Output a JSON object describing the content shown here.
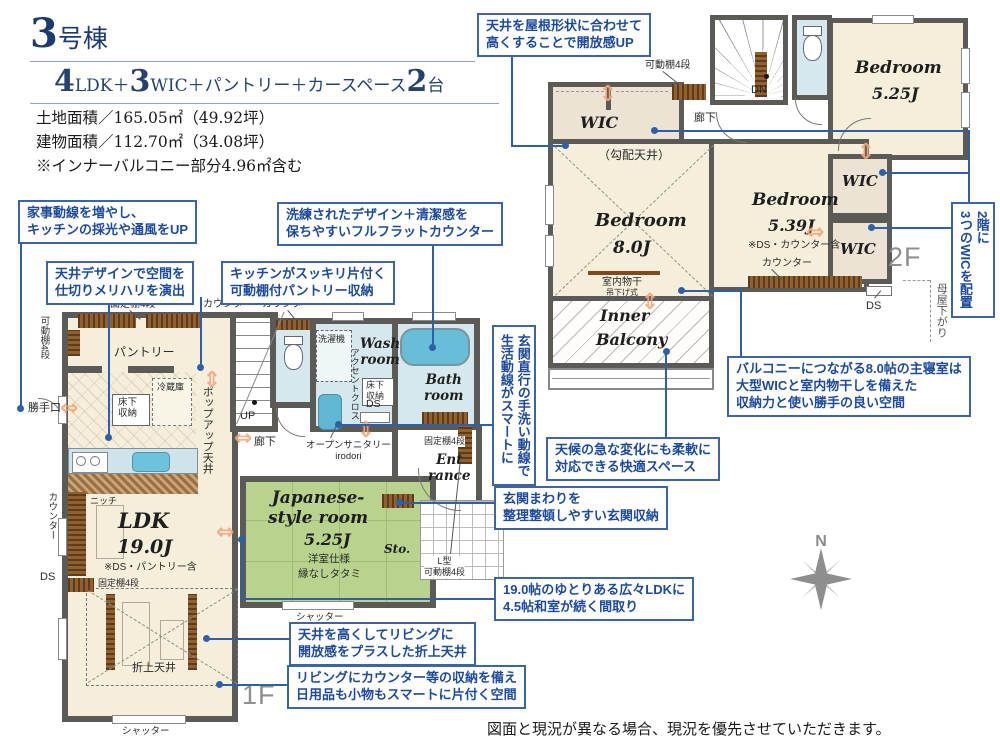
{
  "header": {
    "building_digit": "3",
    "building_suffix": "号棟",
    "layout_parts": [
      "4",
      "LDK＋",
      "3",
      "WIC＋パントリー＋カースペース",
      "2",
      "台"
    ],
    "land_area": "土地面積／165.05㎡（49.92坪）",
    "building_area": "建物面積／112.70㎡（34.08坪）",
    "note": "※インナーバルコニー部分4.96㎡含む"
  },
  "callouts": {
    "roof": "天井を屋根形状に合わせて\n高くすることで開放感UP",
    "kaji": "家事動線を増やし、\nキッチンの採光や通風をUP",
    "flat": "洗練されたデザイン＋清潔感を\n保ちやすいフルフラットカウンター",
    "ceiling": "天井デザインで空間を\n仕切りメリハリを演出",
    "pantry": "キッチンがスッキリ片付く\n可動棚付パントリー収納",
    "washline": "玄関直行の手洗い動線で\n生活動線がスマートに",
    "wic": "2階に\n3つのWICを配置",
    "master": "バルコニーにつながる8.0帖の主寝室は\n大型WICと室内物干しを備えた\n収納力と使い勝手の良い空間",
    "weather": "天候の急な変化にも柔軟に\n対応できる快適スペース",
    "genkan": "玄関まわりを\n整理整頓しやすい玄関収納",
    "ldk": "19.0帖のゆとりある広々LDKに\n4.5帖和室が続く間取り",
    "oriage": "天井を高くしてリビングに\n開放感をプラスした折上天井",
    "living": "リビングにカウンター等の収納を備え\n日用品も小物もスマートに片付く空間"
  },
  "f1": {
    "kadoudana": "可動棚4段",
    "koteidana_top": "固定棚4段",
    "counter_top1": "カウンター",
    "counter_top2": "カウンター",
    "pantry": "パントリー",
    "katteguchi": "勝手口",
    "reizouko": "冷蔵庫",
    "yukashita_k": "床下\n収納",
    "popup": "ポップアップ天井",
    "up": "UP",
    "rouka": "廊下",
    "counter_toilet": "カウンター",
    "sentakuki": "洗濯機",
    "accent": "アクセントクロス",
    "wash_room": "Wash\nroom",
    "yukashita_w": "床下\n収納",
    "ds_wash": "DS",
    "bath_room": "Bath\nroom",
    "open_sanitary": "オープンサニタリー\nirodori",
    "koteidana_ent": "固定棚4段",
    "entrance": "Ent\nrance",
    "sto": "Sto.",
    "l_shelf": "L型\n可動棚4段",
    "shutter1": "シャッター",
    "shutter2": "シャッター",
    "jp_name": "Japanese-\nstyle room",
    "jp_size": "5.25J",
    "jp_note1": "洋室仕様",
    "jp_note2": "縁なしタタミ",
    "ldk_name": "LDK",
    "ldk_size": "19.0J",
    "ldk_note": "※DS・パントリー含",
    "koteidana_ldk": "固定棚4段",
    "ds_left": "DS",
    "counter_left": "カウンター",
    "niche": "ニッチ",
    "oriage": "折上天井",
    "tag": "1F"
  },
  "f2": {
    "kadoudana": "可動棚4段",
    "dn": "DN",
    "rouka": "廊下",
    "wic1": "WIC",
    "wic2": "WIC",
    "wic3": "WIC",
    "kobai": "（勾配天井）",
    "bed8_name": "Bedroom",
    "bed8_size": "8.0J",
    "monohoshi": "室内物干",
    "monohoshi2": "吊下げ式",
    "bed539_name": "Bedroom",
    "bed539_size": "5.39J",
    "bed539_note": "※DS・カウンター含",
    "counter": "カウンター",
    "bed525_name": "Bedroom",
    "bed525_size": "5.25J",
    "inner1": "Inner",
    "inner2": "Balcony",
    "tag": "2F",
    "moya": "母屋下がり",
    "ds": "DS"
  },
  "compass": {
    "n": "N"
  },
  "disclaimer": "図面と現況が異なる場合、現況を優先させていただきます。"
}
